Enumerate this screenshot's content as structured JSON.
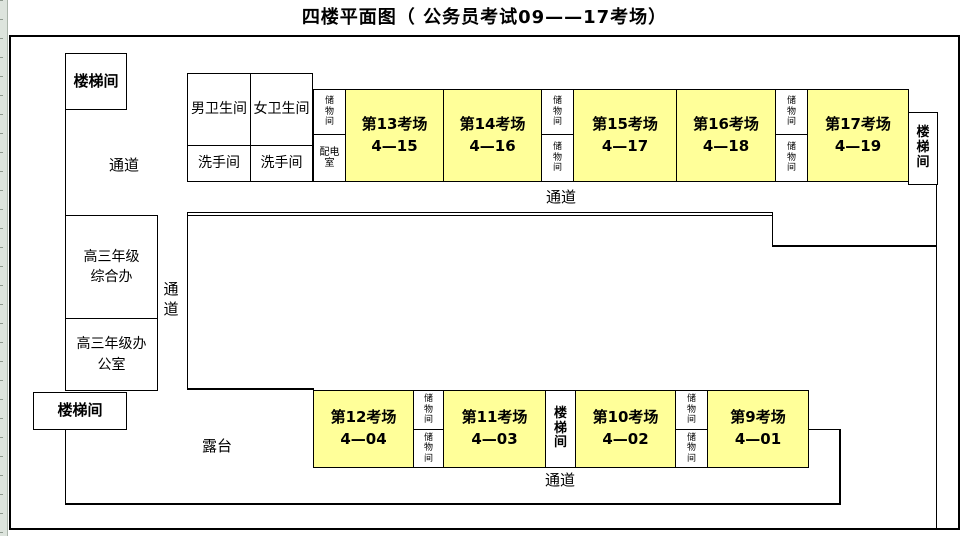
{
  "title": "四楼平面图（ 公务员考试09——17考场）",
  "colors": {
    "exam_fill": "#ffff99",
    "wall": "#000000",
    "background": "#ffffff",
    "excel_strip": "#dde4dd"
  },
  "rooms": [
    {
      "name": "stairwell-top-left",
      "x": 65,
      "y": 53,
      "w": 62,
      "h": 57,
      "lines": [
        "楼梯间"
      ],
      "bold": true,
      "size": 15
    },
    {
      "name": "mens-restroom",
      "x": 187,
      "y": 73,
      "w": 64,
      "h": 73,
      "lines": [
        "男卫生间"
      ],
      "bold": false,
      "size": 14
    },
    {
      "name": "womens-restroom",
      "x": 250,
      "y": 73,
      "w": 63,
      "h": 73,
      "lines": [
        "女卫生间"
      ],
      "bold": false,
      "size": 14
    },
    {
      "name": "washroom-left",
      "x": 187,
      "y": 145,
      "w": 64,
      "h": 37,
      "lines": [
        "洗手间"
      ],
      "bold": false,
      "size": 14
    },
    {
      "name": "washroom-right",
      "x": 250,
      "y": 145,
      "w": 63,
      "h": 37,
      "lines": [
        "洗手间"
      ],
      "bold": false,
      "size": 14
    },
    {
      "name": "storage-top-1",
      "x": 313,
      "y": 89,
      "w": 33,
      "h": 46,
      "lines": [
        "储",
        "物",
        "间"
      ],
      "bold": false,
      "size": 9,
      "small": true
    },
    {
      "name": "power-distribution-room",
      "x": 313,
      "y": 134,
      "w": 33,
      "h": 48,
      "lines": [
        "配电",
        "室"
      ],
      "bold": false,
      "size": 10,
      "small": true
    },
    {
      "name": "exam-room-13",
      "x": 345,
      "y": 89,
      "w": 99,
      "h": 93,
      "lines": [
        "第13考场",
        "4—15"
      ],
      "bold": true,
      "size": 15,
      "fill": "exam"
    },
    {
      "name": "exam-room-14",
      "x": 443,
      "y": 89,
      "w": 99,
      "h": 93,
      "lines": [
        "第14考场",
        "4—16"
      ],
      "bold": true,
      "size": 15,
      "fill": "exam"
    },
    {
      "name": "storage-top-2",
      "x": 541,
      "y": 89,
      "w": 33,
      "h": 46,
      "lines": [
        "储",
        "物",
        "间"
      ],
      "bold": false,
      "size": 9,
      "small": true
    },
    {
      "name": "storage-top-3",
      "x": 541,
      "y": 134,
      "w": 33,
      "h": 48,
      "lines": [
        "储",
        "物",
        "间"
      ],
      "bold": false,
      "size": 9,
      "small": true
    },
    {
      "name": "exam-room-15",
      "x": 573,
      "y": 89,
      "w": 104,
      "h": 93,
      "lines": [
        "第15考场",
        "4—17"
      ],
      "bold": true,
      "size": 15,
      "fill": "exam"
    },
    {
      "name": "exam-room-16",
      "x": 676,
      "y": 89,
      "w": 100,
      "h": 93,
      "lines": [
        "第16考场",
        "4—18"
      ],
      "bold": true,
      "size": 15,
      "fill": "exam"
    },
    {
      "name": "storage-top-4",
      "x": 775,
      "y": 89,
      "w": 33,
      "h": 46,
      "lines": [
        "储",
        "物",
        "间"
      ],
      "bold": false,
      "size": 9,
      "small": true
    },
    {
      "name": "storage-top-5",
      "x": 775,
      "y": 134,
      "w": 33,
      "h": 48,
      "lines": [
        "储",
        "物",
        "间"
      ],
      "bold": false,
      "size": 9,
      "small": true
    },
    {
      "name": "exam-room-17",
      "x": 807,
      "y": 89,
      "w": 102,
      "h": 93,
      "lines": [
        "第17考场",
        "4—19"
      ],
      "bold": true,
      "size": 15,
      "fill": "exam"
    },
    {
      "name": "stairwell-top-right",
      "x": 908,
      "y": 112,
      "w": 30,
      "h": 73,
      "lines": [
        "楼",
        "梯",
        "间"
      ],
      "bold": true,
      "size": 13,
      "small": true
    },
    {
      "name": "grade3-general-office",
      "x": 65,
      "y": 215,
      "w": 93,
      "h": 104,
      "lines": [
        "高三年级",
        "综合办"
      ],
      "bold": false,
      "size": 14
    },
    {
      "name": "grade3-office",
      "x": 65,
      "y": 318,
      "w": 93,
      "h": 73,
      "lines": [
        "高三年级办",
        "公室"
      ],
      "bold": false,
      "size": 14
    },
    {
      "name": "stairwell-bottom-left",
      "x": 33,
      "y": 392,
      "w": 94,
      "h": 38,
      "lines": [
        "楼梯间"
      ],
      "bold": true,
      "size": 15
    },
    {
      "name": "exam-room-12",
      "x": 313,
      "y": 390,
      "w": 101,
      "h": 78,
      "lines": [
        "第12考场",
        "4—04"
      ],
      "bold": true,
      "size": 15,
      "fill": "exam"
    },
    {
      "name": "storage-bottom-1",
      "x": 413,
      "y": 390,
      "w": 31,
      "h": 40,
      "lines": [
        "储",
        "物",
        "间"
      ],
      "bold": false,
      "size": 9,
      "small": true
    },
    {
      "name": "storage-bottom-2",
      "x": 413,
      "y": 429,
      "w": 31,
      "h": 39,
      "lines": [
        "储",
        "物",
        "间"
      ],
      "bold": false,
      "size": 9,
      "small": true
    },
    {
      "name": "exam-room-11",
      "x": 443,
      "y": 390,
      "w": 103,
      "h": 78,
      "lines": [
        "第11考场",
        "4—03"
      ],
      "bold": true,
      "size": 15,
      "fill": "exam"
    },
    {
      "name": "stairwell-bottom-middle",
      "x": 545,
      "y": 390,
      "w": 31,
      "h": 78,
      "lines": [
        "楼",
        "梯",
        "间"
      ],
      "bold": true,
      "size": 13,
      "small": true
    },
    {
      "name": "exam-room-10",
      "x": 575,
      "y": 390,
      "w": 101,
      "h": 78,
      "lines": [
        "第10考场",
        "4—02"
      ],
      "bold": true,
      "size": 15,
      "fill": "exam"
    },
    {
      "name": "storage-bottom-3",
      "x": 675,
      "y": 390,
      "w": 33,
      "h": 40,
      "lines": [
        "储",
        "物",
        "间"
      ],
      "bold": false,
      "size": 9,
      "small": true
    },
    {
      "name": "storage-bottom-4",
      "x": 675,
      "y": 429,
      "w": 33,
      "h": 39,
      "lines": [
        "储",
        "物",
        "间"
      ],
      "bold": false,
      "size": 9,
      "small": true
    },
    {
      "name": "exam-room-9",
      "x": 707,
      "y": 390,
      "w": 102,
      "h": 78,
      "lines": [
        "第9考场",
        "4—01"
      ],
      "bold": true,
      "size": 15,
      "fill": "exam"
    }
  ],
  "labels": [
    {
      "name": "corridor-label-upper-left",
      "x": 100,
      "y": 156,
      "w": 48,
      "lines": [
        "通道"
      ],
      "size": 15
    },
    {
      "name": "corridor-label-vertical",
      "x": 158,
      "y": 280,
      "w": 26,
      "lines": [
        "通",
        "道"
      ],
      "size": 15
    },
    {
      "name": "corridor-label-top",
      "x": 536,
      "y": 188,
      "w": 50,
      "lines": [
        "通道"
      ],
      "size": 15
    },
    {
      "name": "corridor-label-bottom",
      "x": 535,
      "y": 471,
      "w": 50,
      "lines": [
        "通道"
      ],
      "size": 15
    },
    {
      "name": "terrace-label",
      "x": 193,
      "y": 437,
      "w": 48,
      "lines": [
        "露台"
      ],
      "size": 15
    }
  ],
  "walls": [
    {
      "name": "left-wall-upper",
      "x": 65,
      "y": 110,
      "w": 1,
      "h": 106
    },
    {
      "name": "left-wall-lower",
      "x": 65,
      "y": 429,
      "w": 1,
      "h": 76
    },
    {
      "name": "bottom-corridor-floor",
      "x": 65,
      "y": 503,
      "w": 776,
      "h": 2
    },
    {
      "name": "bottom-corridor-right-wall",
      "x": 839,
      "y": 429,
      "w": 2,
      "h": 76
    },
    {
      "name": "bottom-corridor-top-right",
      "x": 808,
      "y": 429,
      "w": 32,
      "h": 1
    },
    {
      "name": "central-block-top",
      "x": 187,
      "y": 212,
      "w": 586,
      "h": 4,
      "style": "double"
    },
    {
      "name": "central-block-left",
      "x": 187,
      "y": 213,
      "w": 1,
      "h": 177
    },
    {
      "name": "central-block-bottom",
      "x": 187,
      "y": 388,
      "w": 127,
      "h": 2
    },
    {
      "name": "central-step-wall",
      "x": 772,
      "y": 213,
      "w": 1,
      "h": 34
    },
    {
      "name": "right-section-top",
      "x": 772,
      "y": 245,
      "w": 165,
      "h": 2
    },
    {
      "name": "right-outer-wall",
      "x": 936,
      "y": 185,
      "w": 1,
      "h": 344
    }
  ]
}
